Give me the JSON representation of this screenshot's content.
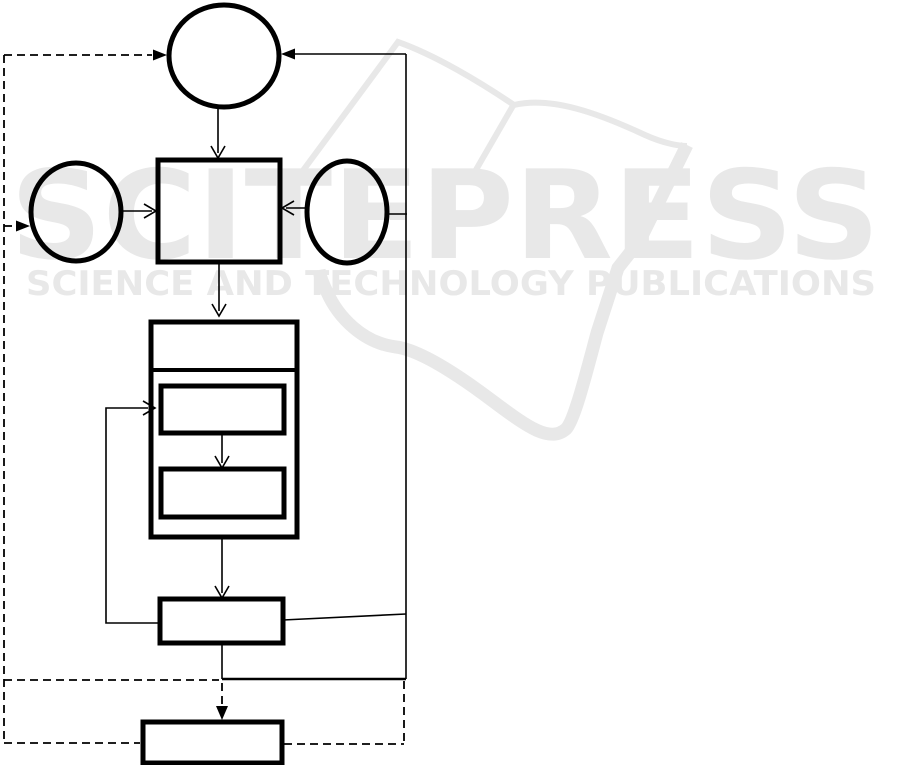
{
  "watermark": {
    "title": "SCITEPRESS",
    "subtitle": "SCIENCE AND TECHNOLOGY PUBLICATIONS",
    "color": "#e8e8e8"
  },
  "diagram": {
    "background_color": "#ffffff",
    "line_color": "#000000",
    "nodes": [
      {
        "id": "start-circle",
        "shape": "circle",
        "label": ""
      },
      {
        "id": "left-input-ellipse",
        "shape": "ellipse",
        "label": ""
      },
      {
        "id": "right-input-ellipse",
        "shape": "ellipse",
        "label": ""
      },
      {
        "id": "process-square",
        "shape": "rectangle",
        "label": ""
      },
      {
        "id": "loop-container",
        "shape": "rectangle-with-header-band",
        "label": ""
      },
      {
        "id": "loop-step-1",
        "shape": "rectangle",
        "label": ""
      },
      {
        "id": "loop-step-2",
        "shape": "rectangle",
        "label": ""
      },
      {
        "id": "post-loop-box",
        "shape": "rectangle",
        "label": ""
      },
      {
        "id": "output-box",
        "shape": "rectangle",
        "label": ""
      }
    ],
    "edges": [
      {
        "from": "left-dashed-rail",
        "to": "start-circle",
        "style": "dashed",
        "arrow": "filled"
      },
      {
        "from": "right-return-line",
        "to": "start-circle",
        "style": "solid",
        "arrow": "filled"
      },
      {
        "from": "start-circle",
        "to": "process-square",
        "style": "solid",
        "arrow": "open"
      },
      {
        "from": "left-dashed-rail",
        "to": "left-input-ellipse",
        "style": "dashed",
        "arrow": "filled"
      },
      {
        "from": "left-input-ellipse",
        "to": "process-square",
        "style": "solid",
        "arrow": "open"
      },
      {
        "from": "right-input-ellipse",
        "to": "process-square",
        "style": "solid",
        "arrow": "open"
      },
      {
        "from": "right-return-line",
        "to": "right-input-ellipse",
        "style": "solid",
        "arrow": "none"
      },
      {
        "from": "process-square",
        "to": "loop-container",
        "style": "solid",
        "arrow": "open"
      },
      {
        "from": "loop-step-1",
        "to": "loop-step-2",
        "style": "solid",
        "arrow": "open"
      },
      {
        "from": "loop-container",
        "to": "post-loop-box",
        "style": "solid",
        "arrow": "open"
      },
      {
        "from": "post-loop-box",
        "to": "loop-step-1",
        "style": "solid",
        "arrow": "open"
      },
      {
        "from": "post-loop-box",
        "to": "right-return-line",
        "style": "solid",
        "arrow": "none"
      },
      {
        "from": "post-loop-box",
        "to": "output-box",
        "style": "dashed",
        "arrow": "filled"
      },
      {
        "from": "output-box",
        "to": "left-dashed-rail",
        "style": "dashed",
        "arrow": "none"
      },
      {
        "from": "output-box",
        "to": "right-dashed-rail",
        "style": "dashed",
        "arrow": "none"
      }
    ]
  }
}
